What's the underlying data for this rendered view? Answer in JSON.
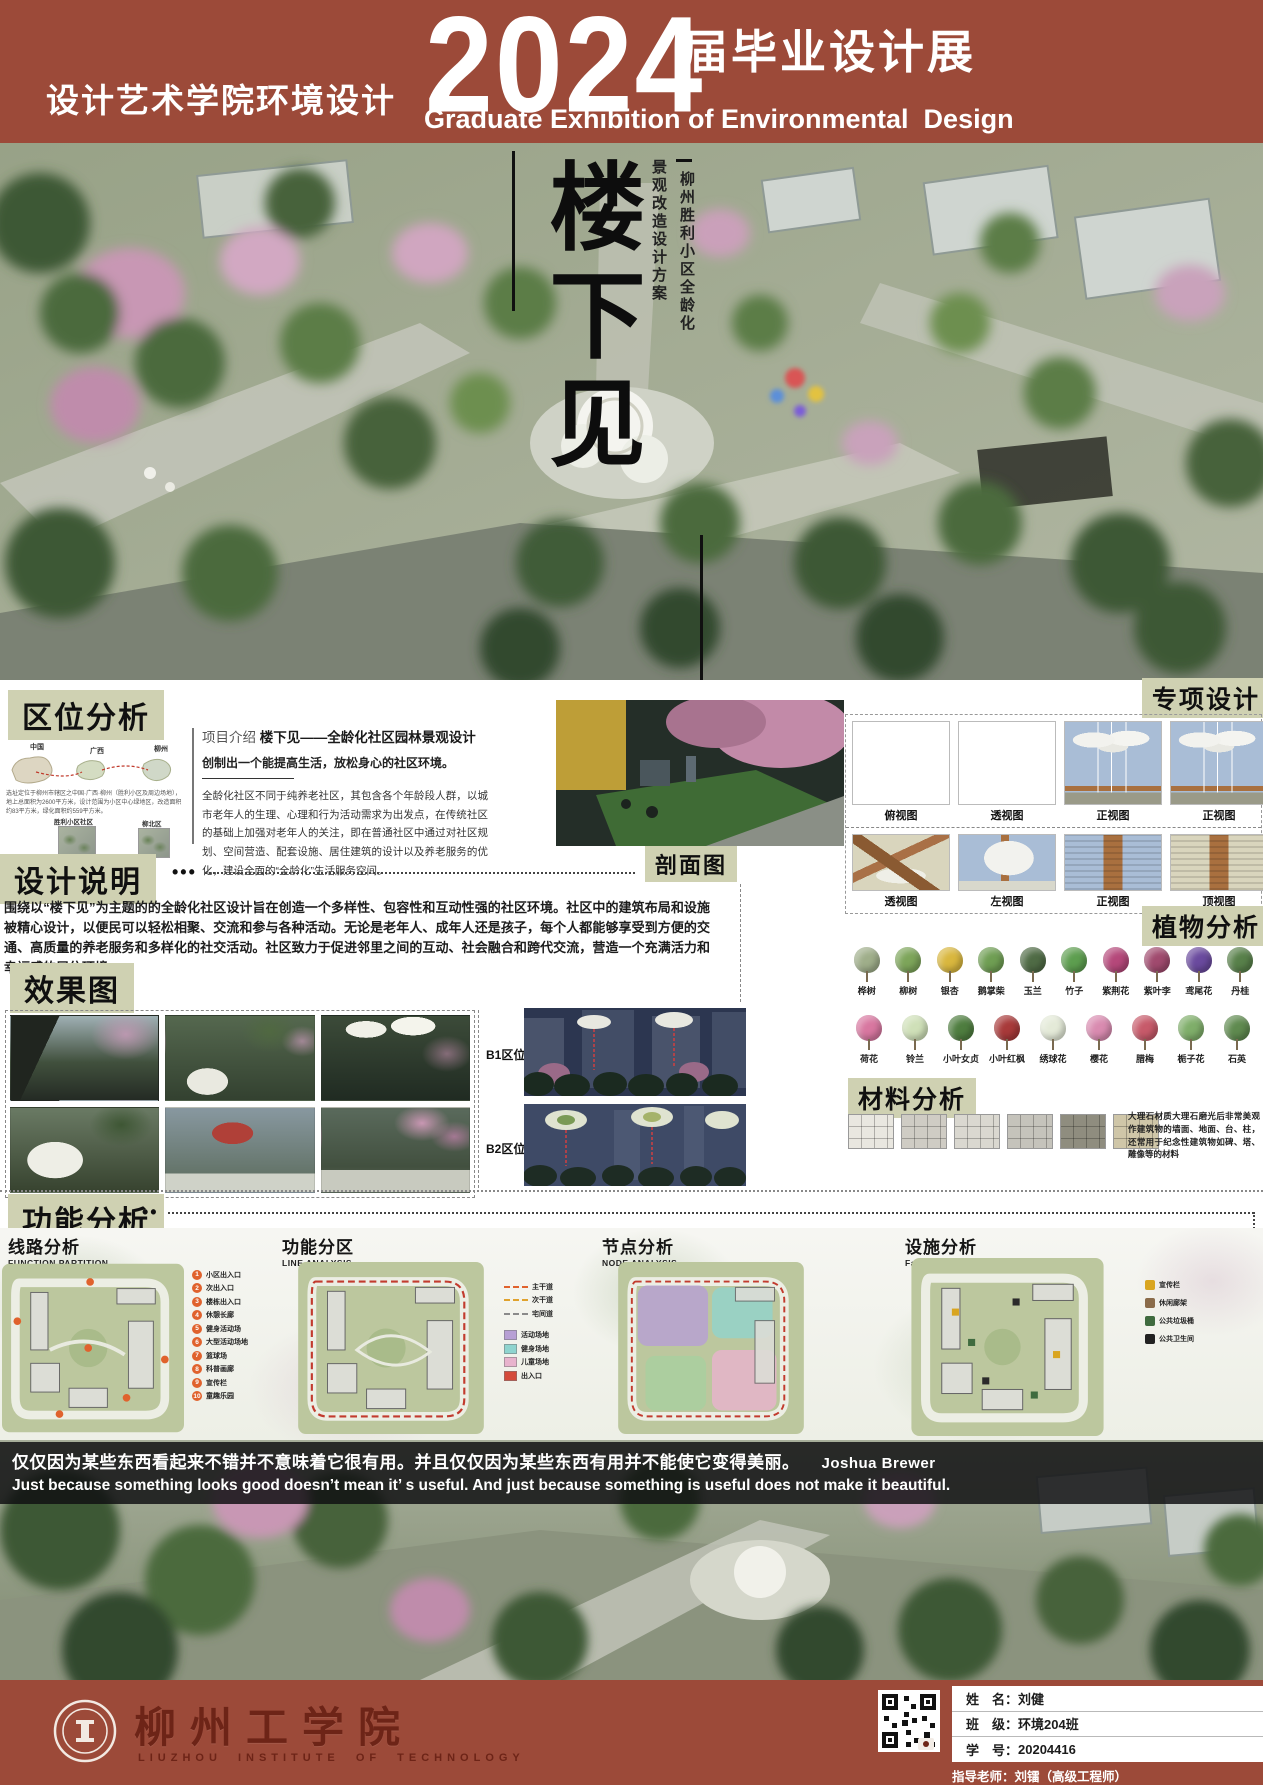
{
  "header": {
    "department": "设计艺术学院环境设计",
    "year": "2024",
    "exhibition_title": "届毕业设计展",
    "exhibition_title_en": "Graduate Exhibition of Environmental  Design"
  },
  "hero": {
    "title": "楼下见",
    "subtitle_line1": "景观改造设计方案",
    "subtitle_line2": "柳州胜利小区全龄化"
  },
  "location": {
    "heading": "区位分析",
    "map_labels": [
      "中国",
      "广西",
      "柳州"
    ],
    "site_labels": [
      "胜利小区社区",
      "柳北区"
    ],
    "caption": "选址定位于柳州市辖区之中国·广西·柳州（胜利小区及周边场地），地上总面积为2600平方米，设计范围为小区中心绿地区，改造面积约83平方米，绿化面积约559平方米。",
    "intro_label": "项目介绍",
    "intro_title": "楼下见——全龄化社区园林景观设计",
    "intro_lead": "创制出一个能提高生活，放松身心的社区环境。",
    "intro_body": "全龄化社区不同于纯养老社区，其包含各个年龄段人群，以城市老年人的生理、心理和行为活动需求为出发点，在传统社区的基础上加强对老年人的关注，即在普通社区中通过对社区规划、空间营造、配套设施、居住建筑的设计以及养老服务的优化，建设全面的“全龄化”生活服务空间。"
  },
  "special_design": {
    "heading": "专项设计",
    "row1_labels": [
      "俯视图",
      "透视图",
      "正视图",
      "正视图"
    ],
    "row2_labels": [
      "透视图",
      "左视图",
      "正视图",
      "顶视图"
    ]
  },
  "design_notes": {
    "heading": "设计说明",
    "body": "围绕以“楼下见”为主题的的全龄化社区设计旨在创造一个多样性、包容性和互动性强的社区环境。社区中的建筑布局和设施被精心设计，以便民可以轻松相聚、交流和参与各种活动。无论是老年人、成年人还是孩子，每个人都能够享受到方便的交通、高质量的养老服务和多样化的社交活动。社区致力于促进邻里之间的互动、社会融合和跨代交流，营造一个充满活力和幸福感的居住环境。"
  },
  "sections_view": {
    "heading": "剖面图",
    "b1_label": "B1区位",
    "b2_label": "B2区位"
  },
  "renders": {
    "heading": "效果图"
  },
  "plants": {
    "heading": "植物分析",
    "row1": [
      {
        "name": "桦树",
        "c": "#9fae8a"
      },
      {
        "name": "柳树",
        "c": "#7da55a"
      },
      {
        "name": "银杏",
        "c": "#d9b73e"
      },
      {
        "name": "鹅掌柴",
        "c": "#6f9e53"
      },
      {
        "name": "玉兰",
        "c": "#4f6b45"
      },
      {
        "name": "竹子",
        "c": "#5d9e4f"
      },
      {
        "name": "紫荆花",
        "c": "#b5487a"
      },
      {
        "name": "紫叶李",
        "c": "#a04a6e"
      },
      {
        "name": "鸢尾花",
        "c": "#6a4a9e"
      },
      {
        "name": "丹桂",
        "c": "#58804a"
      }
    ],
    "row2": [
      {
        "name": "荷花",
        "c": "#d877a0"
      },
      {
        "name": "铃兰",
        "c": "#cfe0b8"
      },
      {
        "name": "小叶女贞",
        "c": "#4e7d3f"
      },
      {
        "name": "小叶红枫",
        "c": "#a83a3a"
      },
      {
        "name": "绣球花",
        "c": "#e4ead8"
      },
      {
        "name": "樱花",
        "c": "#d98bb0"
      },
      {
        "name": "腊梅",
        "c": "#c75a6a"
      },
      {
        "name": "栀子花",
        "c": "#7fae6a"
      },
      {
        "name": "石英",
        "c": "#5f8a4f"
      }
    ]
  },
  "materials": {
    "heading": "材料分析",
    "swatches": [
      "#e9e7e0",
      "#cfccc4",
      "#dad8d0",
      "#c5c3bb",
      "#8f8d7f",
      "#cfc6a8"
    ],
    "description": "大理石材质大理石磨光后非常美观作建筑物的墙面、地面、台、柱，还常用于纪念性建筑物如碑、塔、雕像等的材料"
  },
  "function_analysis": {
    "heading": "功能分析",
    "diagrams": [
      {
        "title": "线路分析",
        "en": "FUNCTION PARTITION"
      },
      {
        "title": "功能分区",
        "en": "LINE ANALYSIS"
      },
      {
        "title": "节点分析",
        "en": "NODE ANALYSIS"
      },
      {
        "title": "设施分析",
        "en": "Facility Analysis Diagram"
      }
    ],
    "route_legend": [
      {
        "num": "1",
        "label": "小区出入口"
      },
      {
        "num": "2",
        "label": "次出入口"
      },
      {
        "num": "3",
        "label": "楼栋出入口"
      },
      {
        "num": "4",
        "label": "休憩长廊"
      },
      {
        "num": "5",
        "label": "健身活动场"
      },
      {
        "num": "6",
        "label": "大型活动场地"
      },
      {
        "num": "7",
        "label": "篮球场"
      },
      {
        "num": "8",
        "label": "科普画廊"
      },
      {
        "num": "9",
        "label": "宣传栏"
      },
      {
        "num": "10",
        "label": "童趣乐园"
      }
    ],
    "node_legend_lines": [
      {
        "label": "主干道",
        "c": "#e0622d"
      },
      {
        "label": "次干道",
        "c": "#e0a22d"
      },
      {
        "label": "宅间道",
        "c": "#8a8a8a"
      }
    ],
    "node_legend_zones": [
      {
        "label": "活动场地",
        "c": "#b79fd4"
      },
      {
        "label": "健身场地",
        "c": "#8fd4cf"
      },
      {
        "label": "儿童场地",
        "c": "#e8b3cd"
      },
      {
        "label": "出入口",
        "c": "#d44a3a"
      }
    ],
    "facility_legend": [
      {
        "label": "宣传栏",
        "c": "#d9a520"
      },
      {
        "label": "休闲廊架",
        "c": "#8a6b4a"
      },
      {
        "label": "公共垃圾桶",
        "c": "#3f6b3f"
      },
      {
        "label": "公共卫生间",
        "c": "#222222"
      }
    ]
  },
  "quote": {
    "zh": "仅仅因为某些东西看起来不错并不意味着它很有用。并且仅仅因为某些东西有用并不能使它变得美丽。",
    "author": "Joshua Brewer",
    "en": "Just because something looks good doesn’t mean it’ s useful. And just because something is useful does not make it beautiful."
  },
  "footer": {
    "school": "柳州工学院",
    "school_en": "LIUZHOU INSTITUTE OF TECHNOLOGY",
    "rows": [
      {
        "label": "姓　名：",
        "value": "刘健"
      },
      {
        "label": "班　级：",
        "value": "环境204班"
      },
      {
        "label": "学　号：",
        "value": "20204416"
      }
    ],
    "advisor": "指导老师：刘镭（高级工程师）"
  },
  "colors": {
    "brand_red": "#9c4a39",
    "tag_bg": "#cfd1b2"
  }
}
